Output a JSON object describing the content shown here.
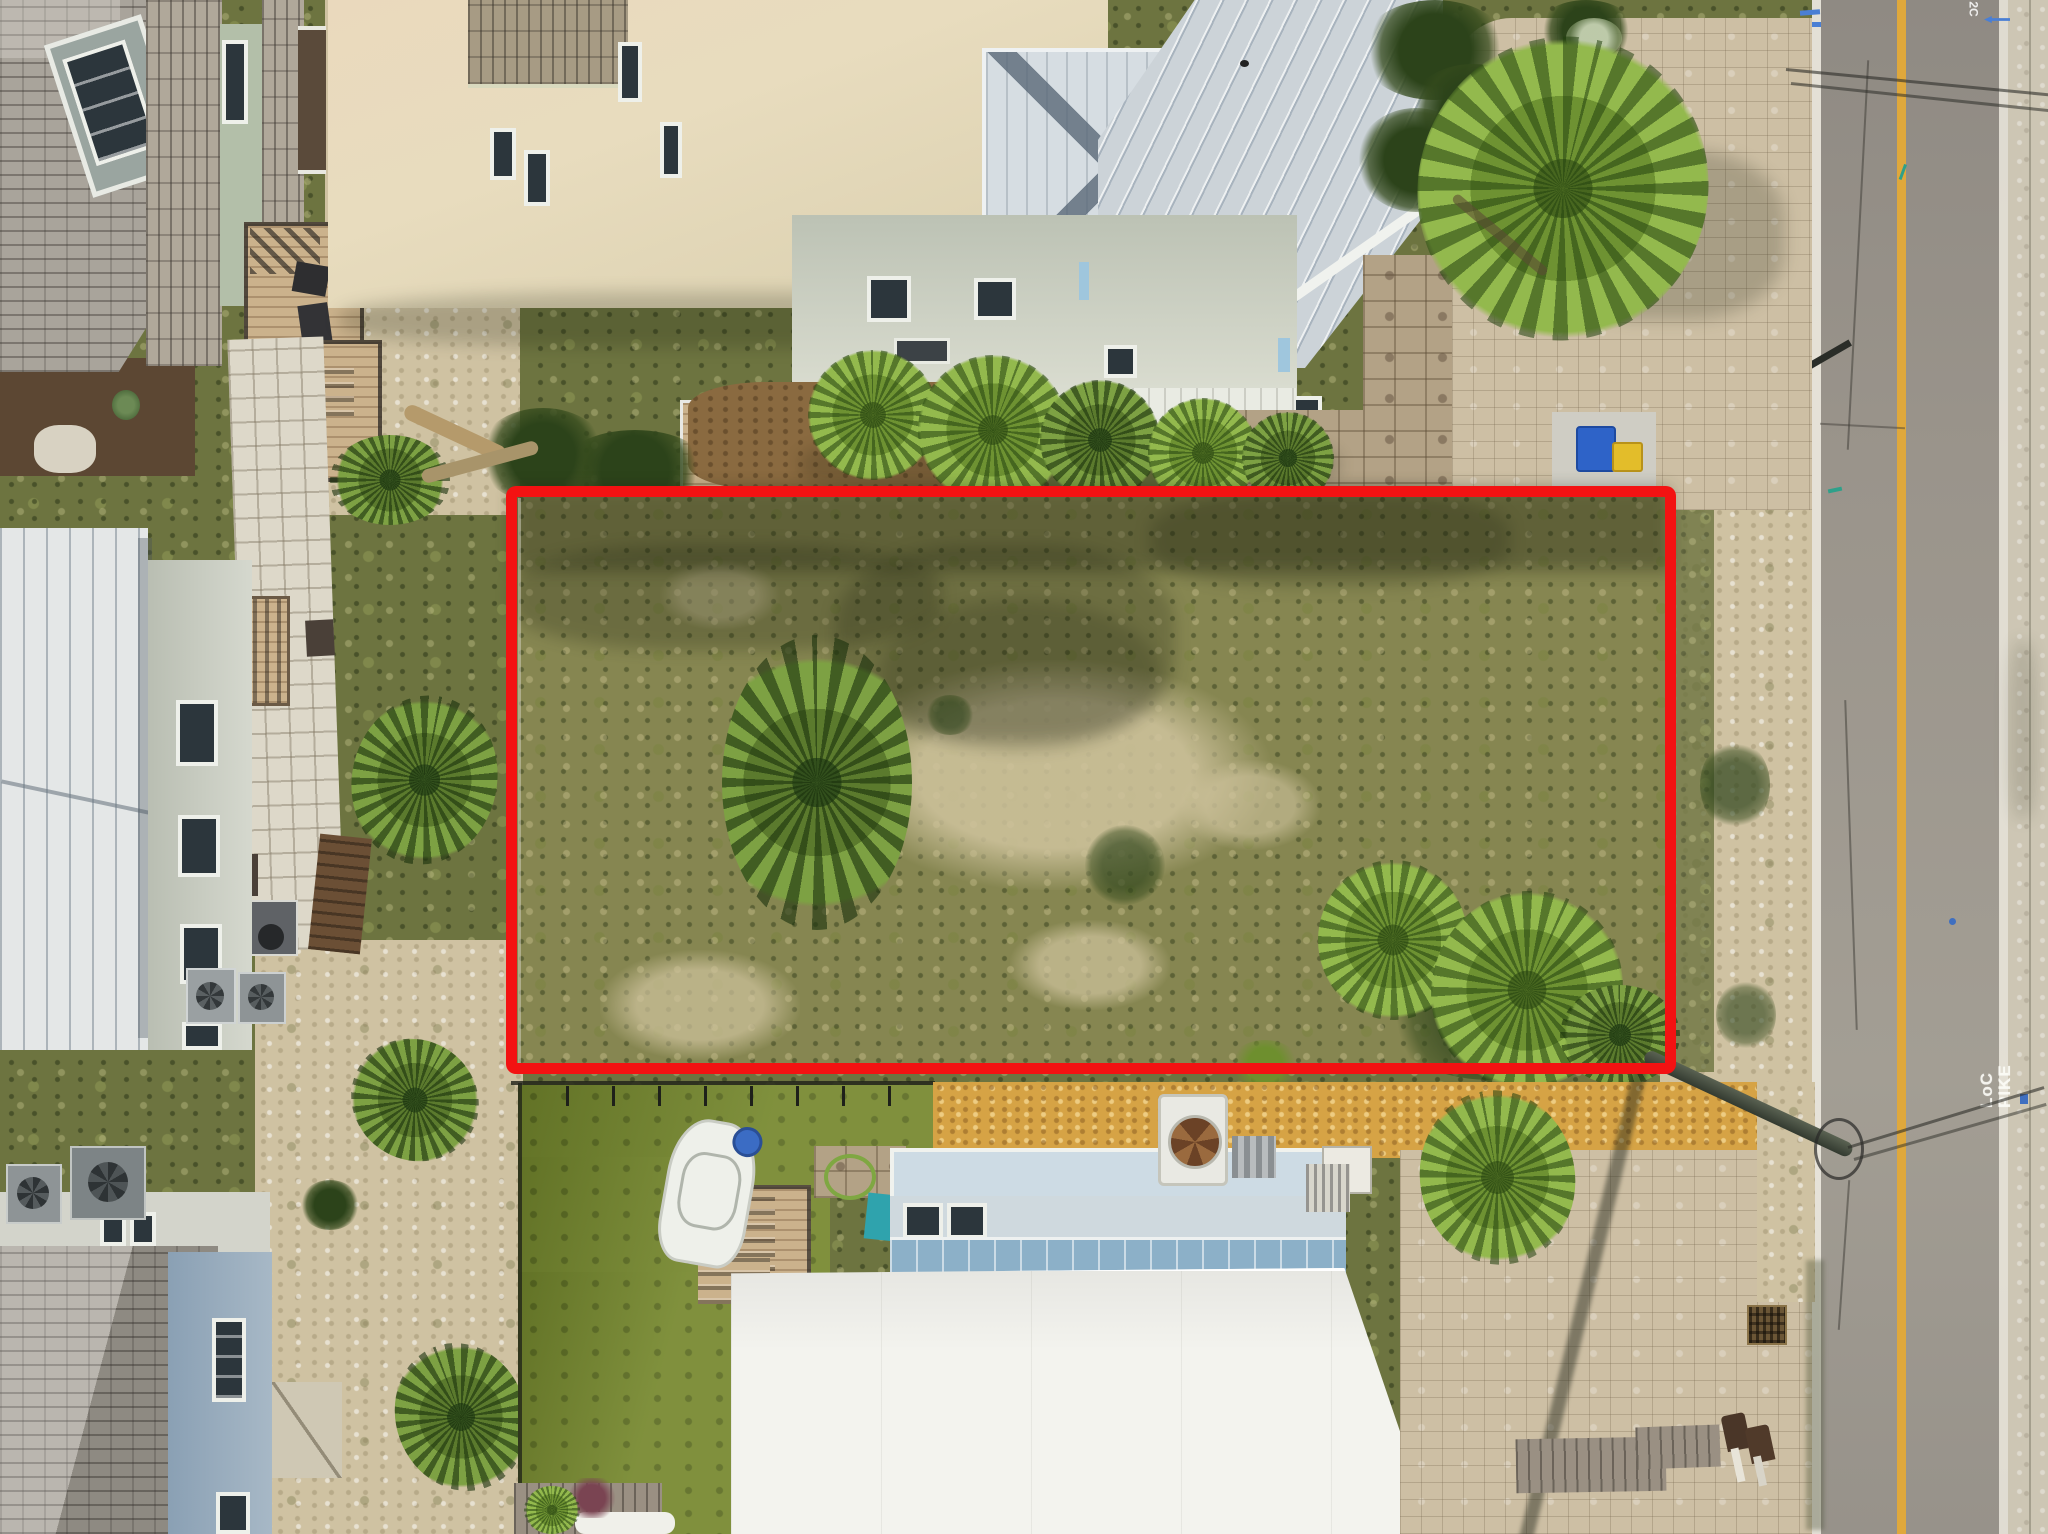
{
  "scene": {
    "type": "aerial-drone-photograph",
    "description": "Top-down aerial view of a vacant coastal residential lot outlined in red, flanked by beach houses with metal and shingle roofs, a green artificial-turf yard below, paver driveways on the right and a vertical two-lane asphalt road with a single yellow centerline",
    "width_px": 2048,
    "height_px": 1534
  },
  "annotation": {
    "label": "property-boundary",
    "shape": "rectangle",
    "stroke_color": "#f31212",
    "stroke_px": 11,
    "bounds_px": {
      "x": 506,
      "y": 486,
      "width": 1170,
      "height": 588
    }
  },
  "road": {
    "orientation": "vertical",
    "surface": "asphalt",
    "centerline": {
      "style": "single-solid-yellow",
      "color": "#dfa83c"
    },
    "edge_line_color": "#f2efe4",
    "markings": [
      {
        "id": "top-mark",
        "text": "2C",
        "color": "#ffffff"
      },
      {
        "id": "locate-line1",
        "text": "LoC",
        "color": "#ffffff"
      },
      {
        "id": "locate-line2",
        "text": "PIKE",
        "color": "#ffffff"
      }
    ],
    "paint_marks": {
      "blue_locate_marks": 5,
      "green_locate_marks": 2
    }
  },
  "site_objects": {
    "trash_bins": [
      "blue-bin",
      "yellow-bin"
    ],
    "utility_pole": "leaning-pole-with-wires-bottom-right",
    "turf_yard": "artificial-grass-with-boat-and-deck",
    "vegetation": "palmetto-palms-and-scrub"
  },
  "palette": {
    "boundary": "#f31212",
    "asphalt": "#9a948b",
    "concrete": "#cdc6b4",
    "yellow": "#dfa83c",
    "turf": "#76882e",
    "gravel": "#d6a345",
    "sand": "#cfc2a2",
    "veg": "#6d7440",
    "lotveg": "#868651",
    "pavers": "#cdbfa4",
    "stone": "#b3a286",
    "whiteroof": "#f3f3ee",
    "blueroof": "#ccd3d8",
    "metal": "#e4e7e7",
    "creamwall": "#e8dcbe",
    "bluewall": "#8aa0b4",
    "wood": "#cbb28c"
  }
}
